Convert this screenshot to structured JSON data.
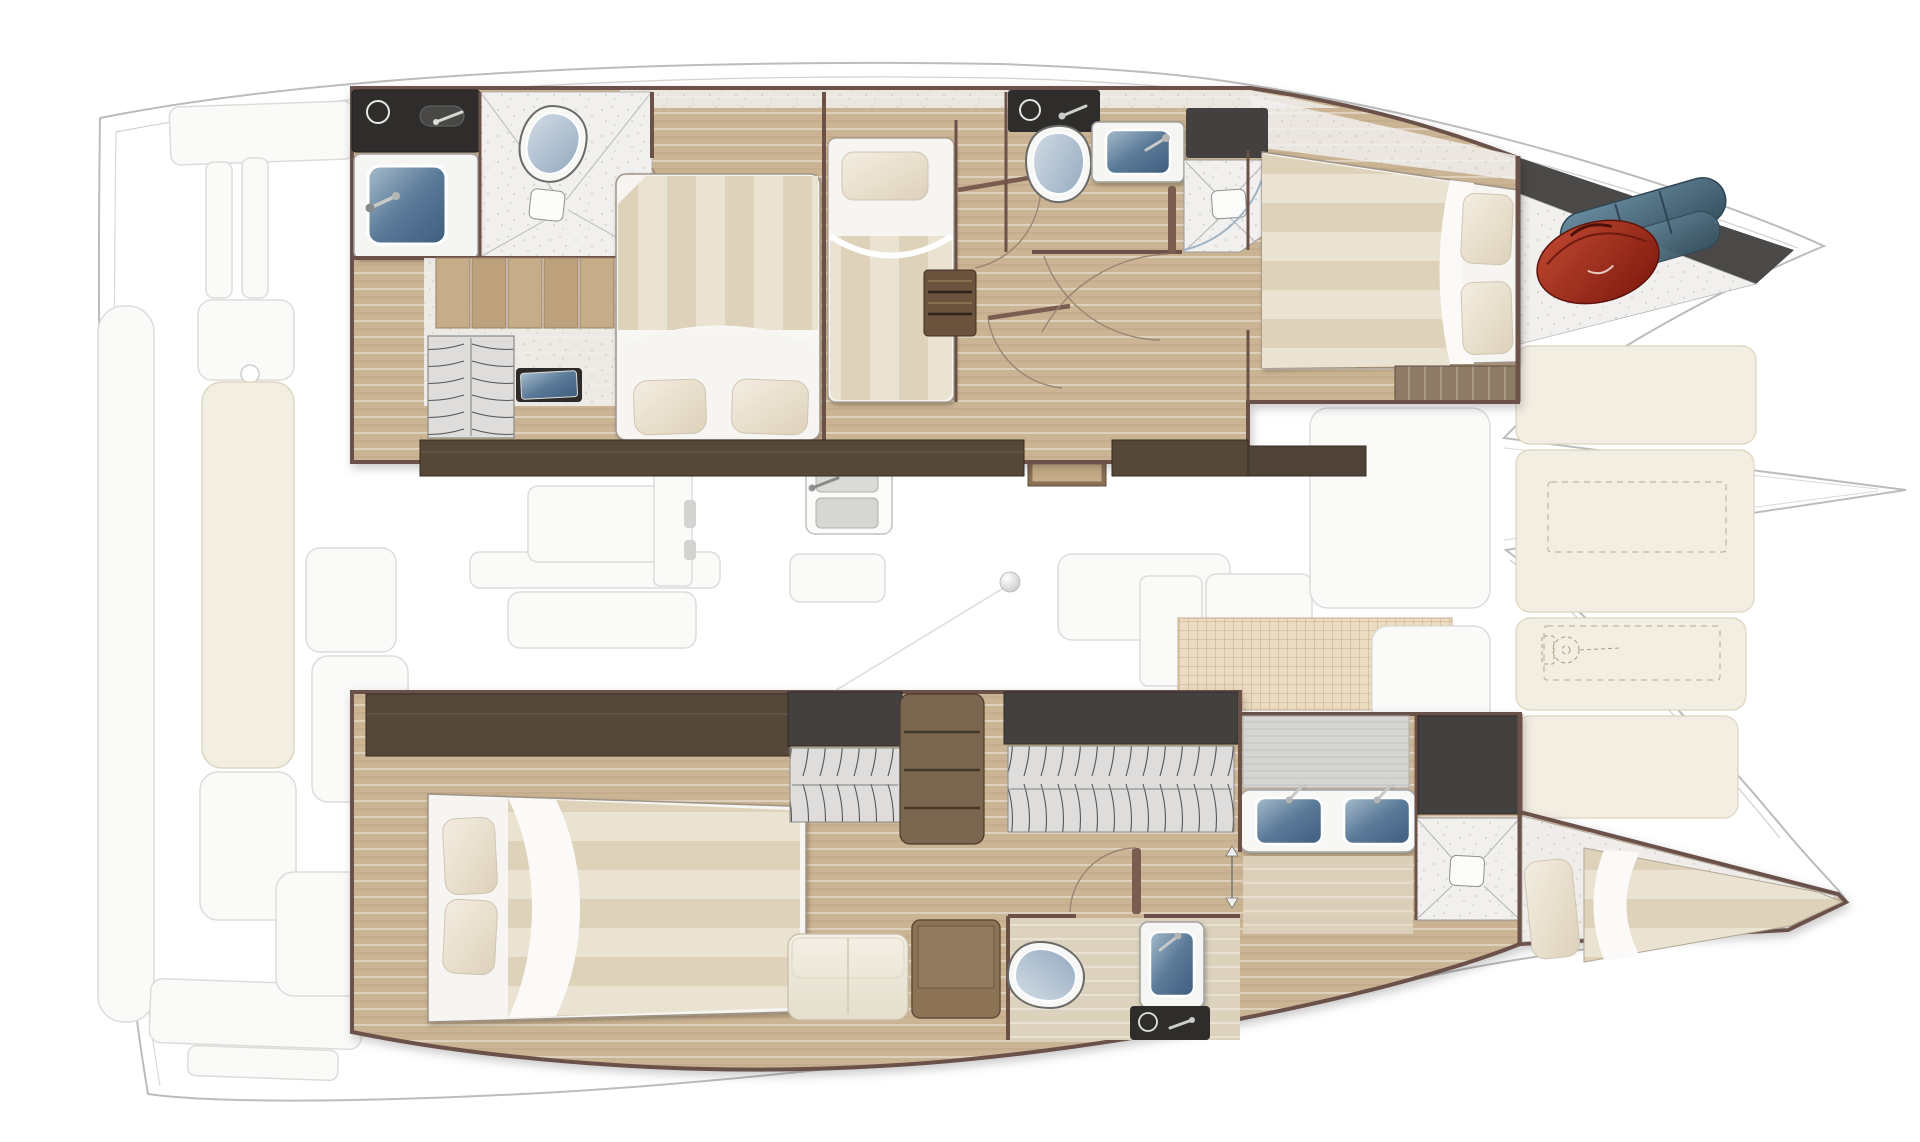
{
  "diagram": {
    "kind": "catamaran-interior-floor-plan",
    "view": "top-down",
    "bow_direction": "right",
    "stern_direction": "left",
    "hull_count": 2
  },
  "palette": {
    "hull-stroke": "#bcbcbc",
    "ghost-stroke": "#dcdcda",
    "wall": "#6b5148",
    "wood": "#cbb493",
    "wood-light": "#ddd2bd",
    "duvet-a": "#ebe3d2",
    "duvet-b": "#ded2ba",
    "louver": "#dedddb",
    "cream": "#f3eee2",
    "dark-counter": "#2f2d2c",
    "dark-cabinet": "#434040",
    "wardrobe": "#554838",
    "shelf-wood": "#7b6750",
    "step-wood": "#c6ac89",
    "sink-blue": "#54718f",
    "toilet-lid": "#a9bccd",
    "grid-base": "#ecdcc2",
    "grid-line": "#bb9c76",
    "bag-red": "#a0301f",
    "fender-blue": "#527185"
  },
  "furniture": {
    "berths": [
      "double-berth-forward-top-hull",
      "single-berth-top-hull",
      "vip-berth-bow",
      "double-berth-aft-bottom-hull",
      "skipper-berth-bow-bottom-hull"
    ],
    "heads": [
      "head-top-hull-aft",
      "head-top-hull-forward",
      "head-bottom-hull"
    ],
    "fixtures": [
      "toilet",
      "sink-vanity",
      "double-sink-vanity",
      "shower-floor",
      "drain",
      "galley-sink"
    ],
    "storage": [
      "louver-locker",
      "shelf-unit",
      "wardrobe-band",
      "tall-cabinet",
      "anchor-locker",
      "steps"
    ],
    "deck": [
      "swim-platform",
      "cockpit-bench-cushion",
      "cockpit-table-ghost",
      "deck-hatch",
      "foredeck-cushion",
      "grid-mat",
      "windlass-outline",
      "bowsprit"
    ],
    "loose-items": [
      "red-duffel-bag",
      "blue-fender-roll",
      "tv-screen",
      "compass-ball"
    ]
  }
}
